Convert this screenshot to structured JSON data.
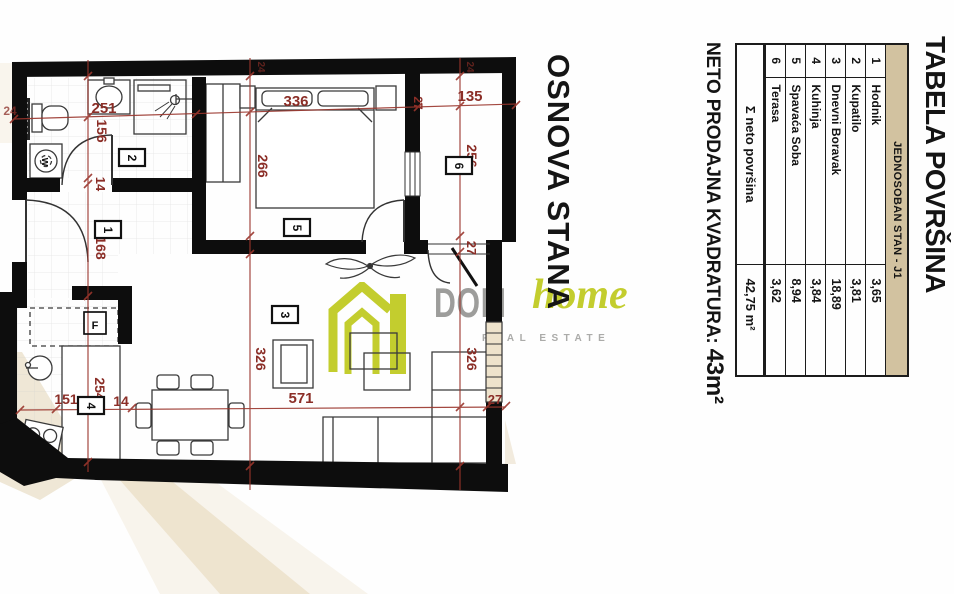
{
  "plan_label": "OSNOVA STANA",
  "logo": {
    "dom": "DOM",
    "home": "home",
    "tagline": "REAL ESTATE",
    "green": "#c3cd2e",
    "gray": "#9d9d9b"
  },
  "area_table": {
    "title": "TABELA POVRŠINA",
    "header": "JEDNOSOBAN STAN - J1",
    "rows": [
      {
        "num": "1",
        "name": "Hodnik",
        "value": "3,65"
      },
      {
        "num": "2",
        "name": "Kupatilo",
        "value": "3,81"
      },
      {
        "num": "3",
        "name": "Dnevni Boravak",
        "value": "18,89"
      },
      {
        "num": "4",
        "name": "Kuhinja",
        "value": "3,84"
      },
      {
        "num": "5",
        "name": "Spavaća Soba",
        "value": "8,94"
      },
      {
        "num": "6",
        "name": "Terasa",
        "value": "3,62"
      }
    ],
    "total_label": "Σ neto površina",
    "total_value": "42,75 m²",
    "net_area_label": "NETO PRODAJNA KVADRATURA:",
    "net_area_value": "43m²",
    "header_bg": "#d2c2a0"
  },
  "floor_plan": {
    "dim_color": "#8b2e27",
    "room_numbers": {
      "r1": "1",
      "r2": "2",
      "r3": "3",
      "r4": "4",
      "r5": "5",
      "r6": "6"
    },
    "fixture_labels": {
      "fridge": "F",
      "washer": "w"
    },
    "dimensions": {
      "d251": "251",
      "d156": "156",
      "d14_hall": "14",
      "d168": "168",
      "d336": "336",
      "d266": "266",
      "d135": "135",
      "d256": "256",
      "d27_terrace_wall": "27",
      "d27_terrace_door": "27",
      "d27_living": "27",
      "d24_left": "24",
      "d24_top_mid": "24",
      "d24_top_right": "24",
      "d254": "254",
      "d151": "151",
      "d14_kitchen": "14",
      "d571": "571",
      "d326_left": "326",
      "d326_right": "326"
    }
  }
}
